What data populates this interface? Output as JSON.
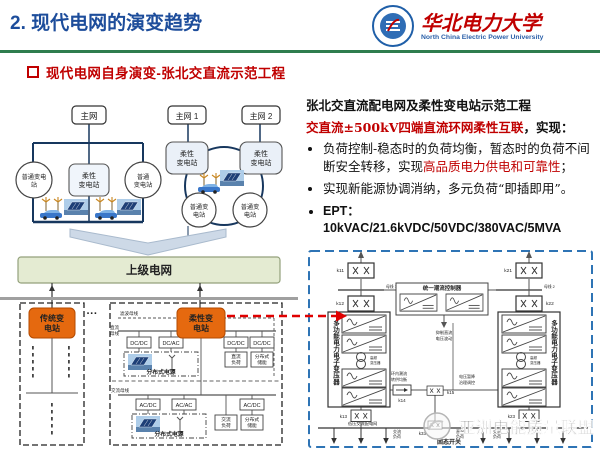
{
  "hd": {
    "title": "2. 现代电网的演变趋势",
    "bullet": "现代电网自身演变-张北交直流示范工程"
  },
  "logo": {
    "cn": "华北电力大学",
    "en": "North China Electric Power University"
  },
  "panel": {
    "title": "张北交直流配电网及柔性变电站示范工程",
    "subtitle_red": "交直流±500kV四端直流环网柔性互联",
    "subtitle_black": "，实现：",
    "b1_pre": "负荷控制-稳态时的负荷均衡，暂态时的负荷不间断安全转移，实现",
    "b1_red": "高品质电力供电和可靠性",
    "b1_post": "；",
    "b2": "实现新能源协调消纳，多元负荷“即插即用”。",
    "b3": "EPT：10kVAC/21.6kVDC/50VDC/380VAC/5MVA"
  },
  "dg": {
    "main": "主网",
    "main1": "主网 1",
    "main2": "主网 2",
    "ns1a": "普通变电",
    "ns1b": "站",
    "ns2a": "普通",
    "ns2b": "变电站",
    "ns3a": "普通变",
    "ns3b": "电站",
    "flex1": "柔性",
    "flex2": "变电站",
    "upper": "上级电网",
    "dots": "···",
    "trad1": "传统变",
    "trad2": "电站",
    "fo1": "柔性变",
    "fo2": "电站",
    "busf": "滤波母线",
    "busdc1": "直流",
    "busdc2": "母线",
    "busac": "交流母线",
    "dcdc": "DC/DC",
    "dcac": "DC/AC",
    "acdc": "AC/DC",
    "acac": "AC/AC",
    "dgs": "分布式电源",
    "dcl1": "直流",
    "dcl2": "负荷",
    "st1": "分布式",
    "st2": "储能",
    "acl1": "交流",
    "acl2": "负荷"
  },
  "cc": {
    "k11": "k11",
    "k12": "k12",
    "k13": "k13",
    "k14": "k14",
    "k15": "k15",
    "k21": "k21",
    "k22": "k22",
    "k23": "k23",
    "k33": "k33",
    "pet": "多功能电力电子变压器",
    "upfc": "统一潮流控制器",
    "hf1": "高频",
    "hf2": "变压器",
    "sss": "固态开关",
    "bus1": "母线 1",
    "bus2": "母线 2",
    "ml1": "环内潮流",
    "ml2": "转供均衡",
    "mr1": "电压暂降",
    "mr2": "治理调控",
    "mc1": "抑制直流",
    "mc2": "电压波动",
    "mbus": "低压交流配电网",
    "acl1": "交流",
    "acl2": "负荷",
    "dcl1": "直流",
    "dcl2": "负荷",
    "wm": "亚洲电能质量联盟"
  },
  "colors": {
    "accent_red": "#c00000",
    "title_blue": "#1d4d9b",
    "green_rule": "#2e7d4e",
    "station_orange": "#e5690f",
    "grid_navy": "#17375e",
    "circuit_blue": "#2e74b5"
  }
}
